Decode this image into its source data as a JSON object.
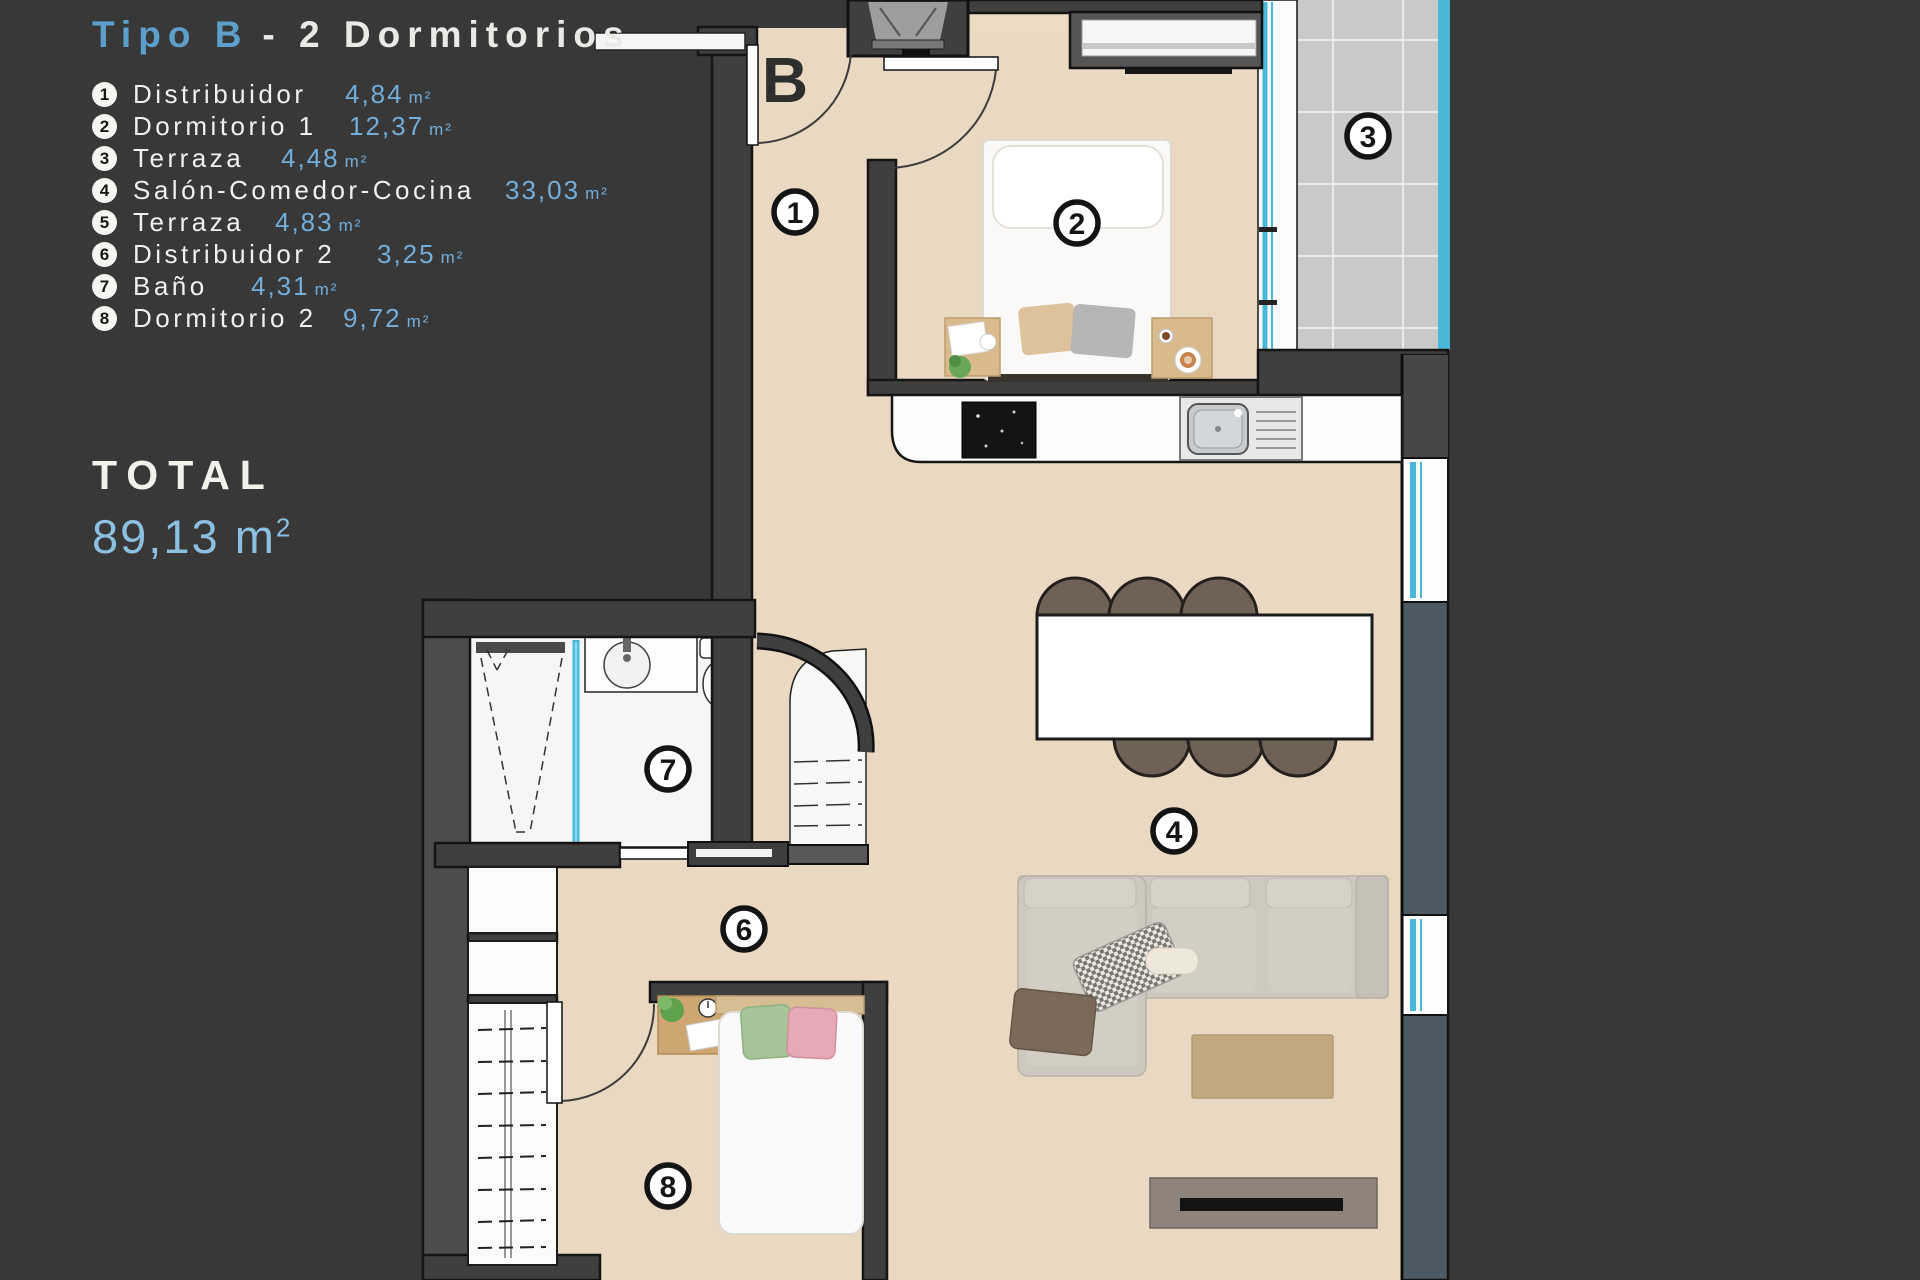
{
  "background_color": "#383838",
  "legend": {
    "title": {
      "highlight": "Tipo B",
      "rest": "- 2 Dormitorios"
    },
    "items": [
      {
        "num": "1",
        "label": "Distribuidor",
        "area": "4,84",
        "unit": "m²"
      },
      {
        "num": "2",
        "label": "Dormitorio 1",
        "area": "12,37",
        "unit": "m²"
      },
      {
        "num": "3",
        "label": "Terraza",
        "area": "4,48",
        "unit": "m²"
      },
      {
        "num": "4",
        "label": "Salón-Comedor-Cocina",
        "area": "33,03",
        "unit": "m²"
      },
      {
        "num": "5",
        "label": "Terraza",
        "area": "4,83",
        "unit": "m²"
      },
      {
        "num": "6",
        "label": "Distribuidor 2",
        "area": "3,25",
        "unit": "m²"
      },
      {
        "num": "7",
        "label": "Baño",
        "area": "4,31",
        "unit": "m²"
      },
      {
        "num": "8",
        "label": "Dormitorio 2",
        "area": "9,72",
        "unit": "m²"
      }
    ],
    "total": {
      "label": "TOTAL",
      "value": "89,13",
      "unit_base": "m",
      "unit_sup": "2"
    }
  },
  "plan": {
    "block_label": "B",
    "room_markers": [
      {
        "num": "1"
      },
      {
        "num": "2"
      },
      {
        "num": "3"
      },
      {
        "num": "4"
      },
      {
        "num": "6"
      },
      {
        "num": "7"
      },
      {
        "num": "8"
      }
    ],
    "colors": {
      "accent_blue": "#5c9fcb",
      "value_blue": "#74add8",
      "floor_beige": "#e9d8c2",
      "wall_dark": "#3f3f3f",
      "glass_cyan": "#49b8d8",
      "tile_gray": "#c9c9c9",
      "counter_white": "#fcfcfb"
    }
  }
}
